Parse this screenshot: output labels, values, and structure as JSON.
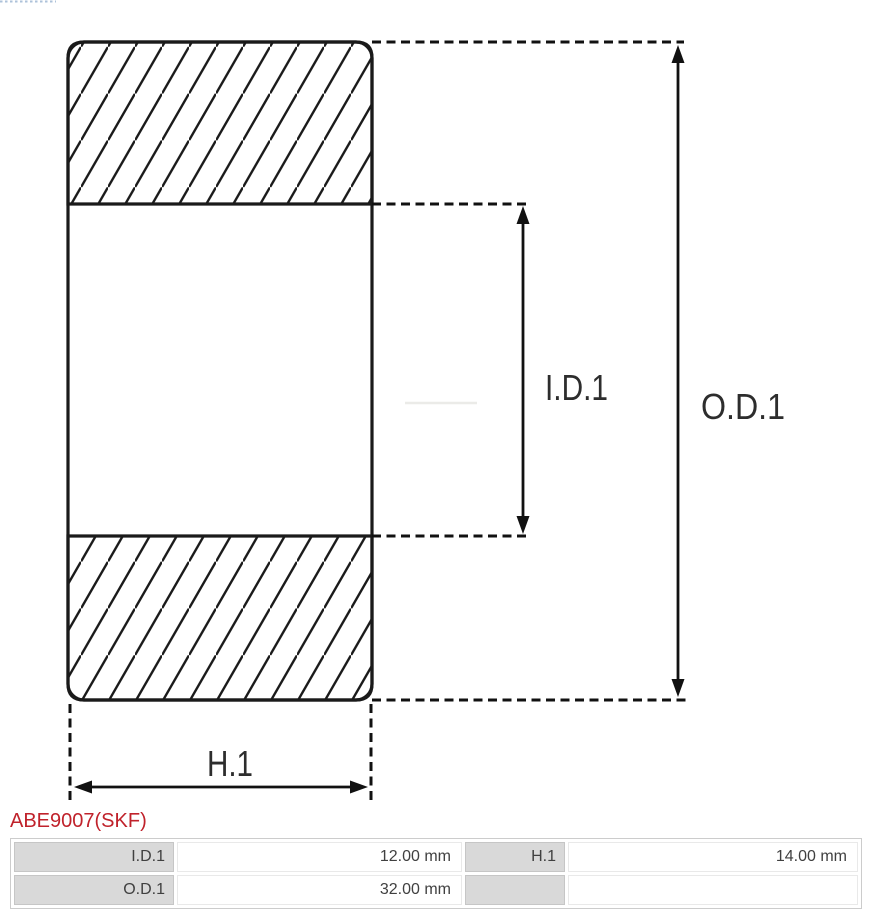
{
  "part": {
    "number": "ABE9007(SKF)"
  },
  "diagram": {
    "id_label": "I.D.1",
    "od_label": "O.D.1",
    "h_label": "H.1"
  },
  "table": {
    "rows": [
      {
        "cells": [
          {
            "label": "I.D.1",
            "value": "12.00 mm"
          },
          {
            "label": "H.1",
            "value": "14.00 mm"
          }
        ]
      },
      {
        "cells": [
          {
            "label": "O.D.1",
            "value": "32.00 mm"
          },
          {
            "label": "",
            "value": ""
          }
        ]
      }
    ]
  },
  "colors": {
    "accent_red": "#c0222b",
    "diagram_line": "#1a1a1a",
    "table_label_bg": "#d9d9d9"
  }
}
